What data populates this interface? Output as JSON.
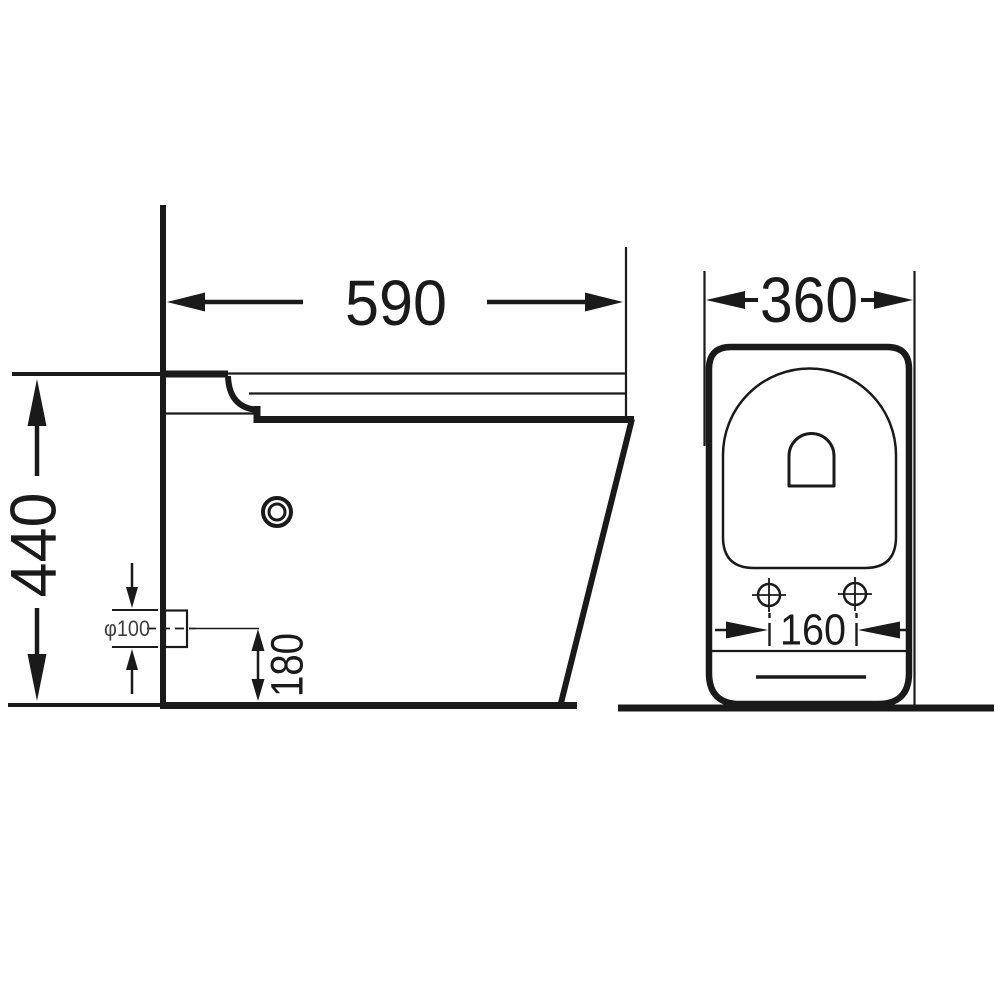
{
  "drawing": {
    "side_view": {
      "depth_label": "590",
      "height_label": "440",
      "outlet_diameter_label": "φ100",
      "outlet_height_label": "180"
    },
    "front_view": {
      "width_label": "360",
      "bolt_spacing_label": "160"
    },
    "colors": {
      "line": "#1a1a1a",
      "outlet_label": "#3d3d3d",
      "background": "#ffffff"
    }
  }
}
